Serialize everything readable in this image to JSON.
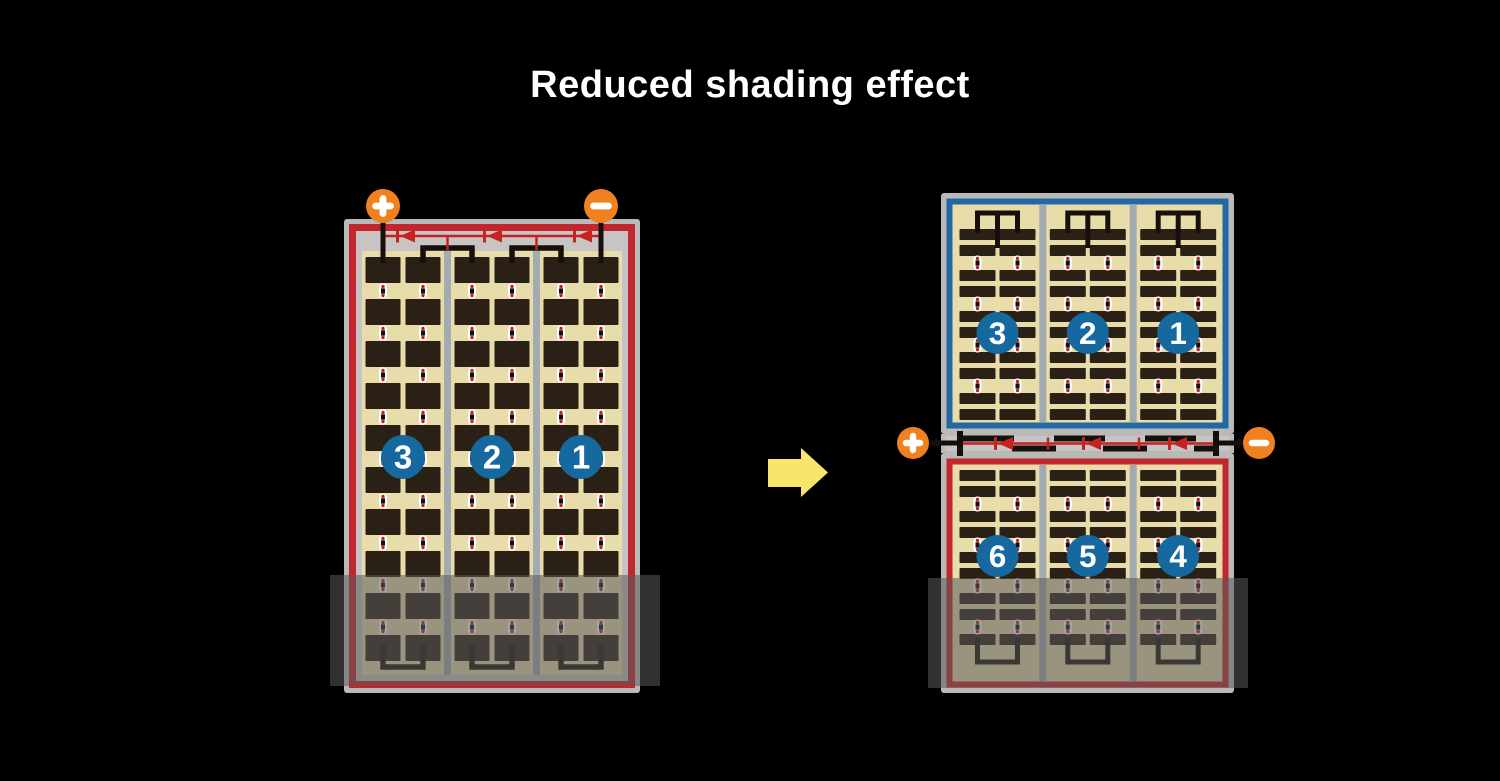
{
  "title": "Reduced shading effect",
  "left_module": {
    "string_badges": [
      "3",
      "2",
      "1"
    ],
    "positive_terminal": "+",
    "negative_terminal": "−"
  },
  "right_module": {
    "top_panel_badges": [
      "3",
      "2",
      "1"
    ],
    "bottom_panel_badges": [
      "6",
      "5",
      "4"
    ],
    "positive_terminal": "+",
    "negative_terminal": "−"
  },
  "icons": {
    "terminal_positive": "plus-icon",
    "terminal_negative": "minus-icon",
    "bypass_diode": "diode-left-icon",
    "transition": "right-arrow-icon"
  },
  "colors": {
    "background": "#000000",
    "title_text": "#ffffff",
    "panel_frame_gray": "#b9bab8",
    "panel_inner_gray": "#c6c5c3",
    "cell_tan": "#e8dcaa",
    "cell_dark": "#2a2015",
    "red_accent": "#c1272d",
    "blue_accent": "#2268a2",
    "badge_blue": "#16699f",
    "terminal_orange": "#f08120",
    "arrow_yellow": "#f8e56a",
    "separator_gray": "#a4abb0",
    "wire_black": "#16100b",
    "connector_white": "#ffffff",
    "connector_red": "#c62222",
    "shade_overlay": "rgba(90,90,90,0.55)"
  }
}
